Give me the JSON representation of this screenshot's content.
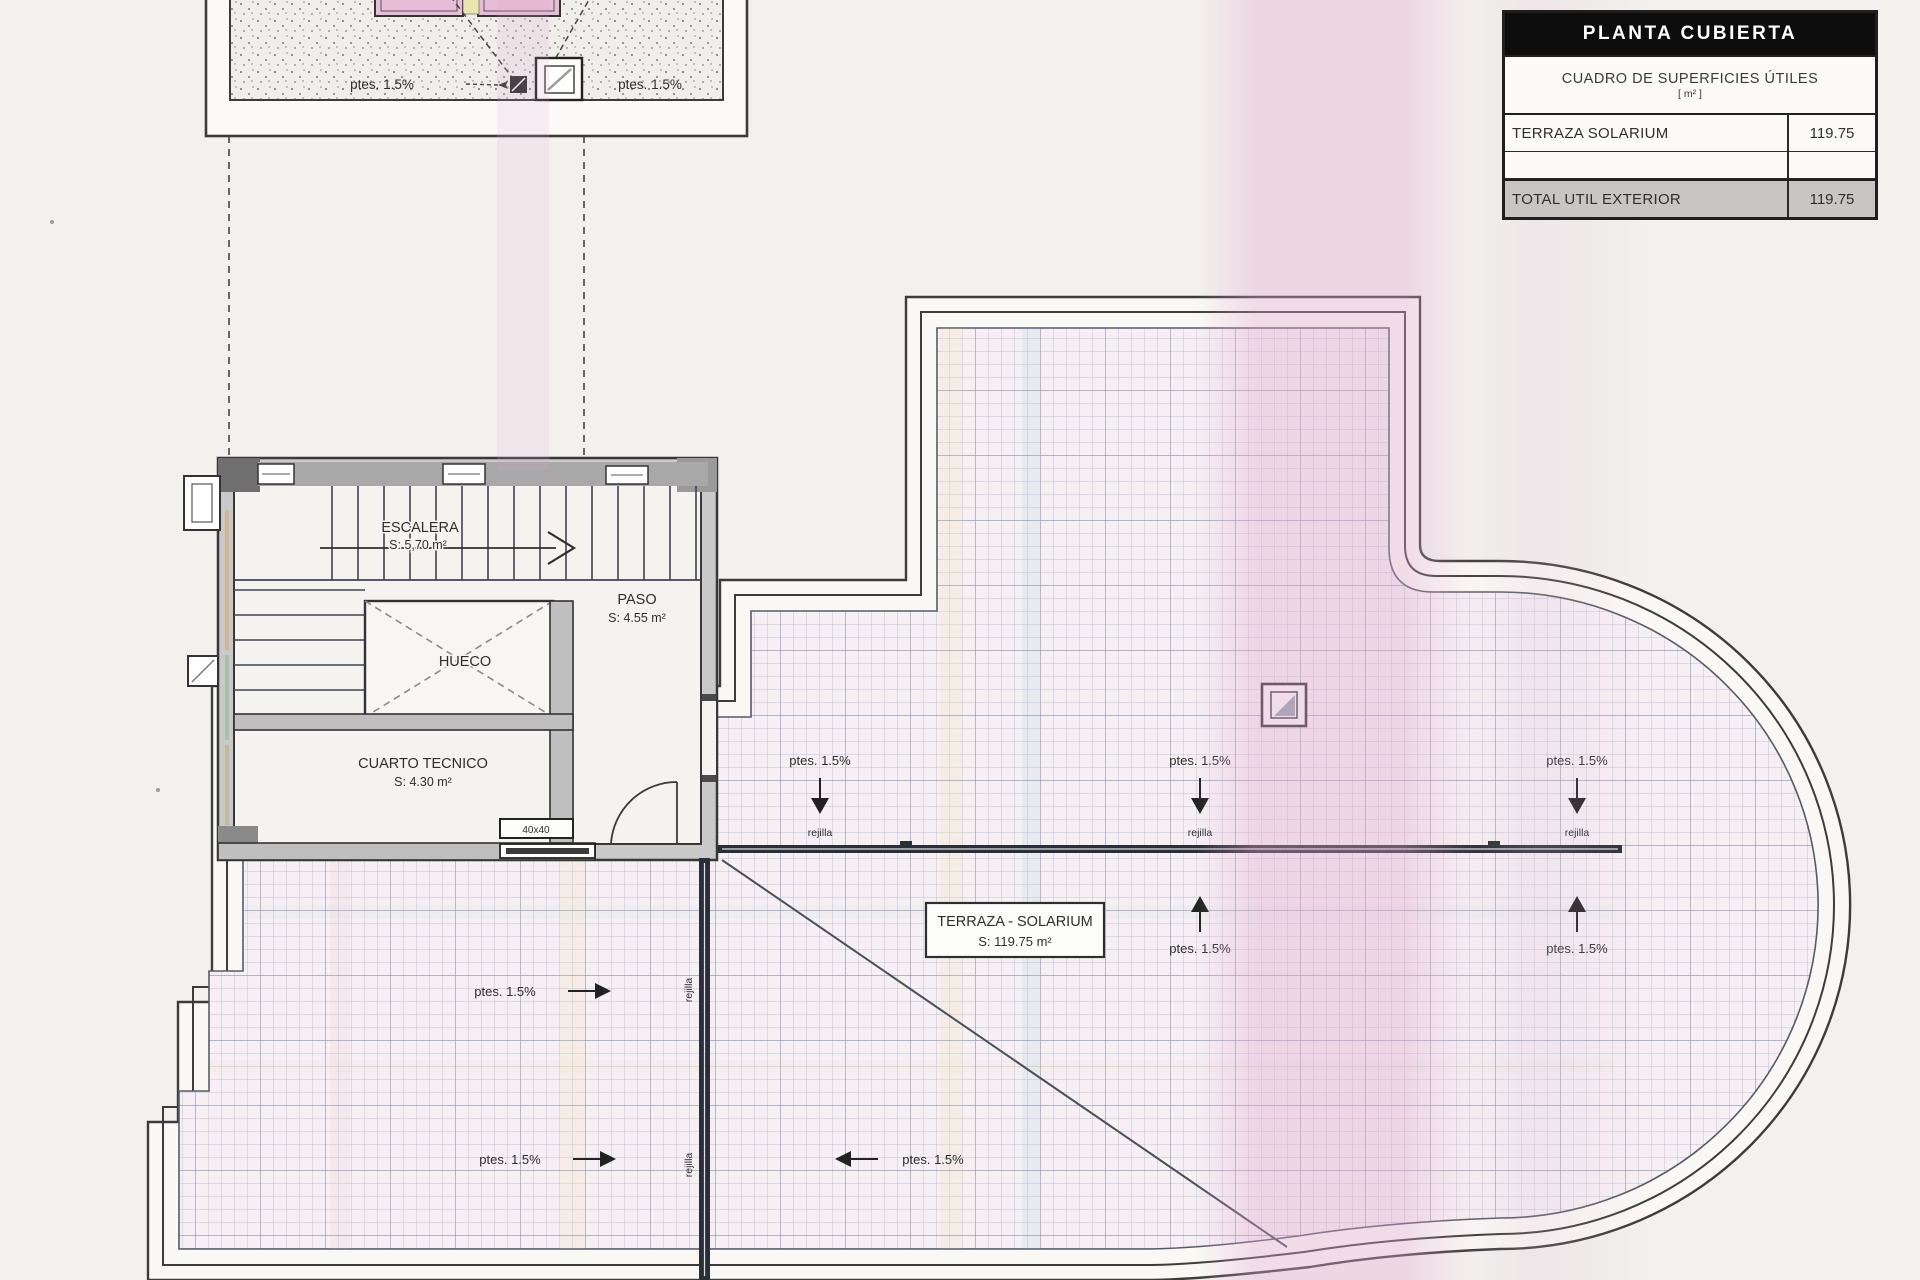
{
  "table": {
    "title": "PLANTA CUBIERTA",
    "subtitle": "CUADRO DE SUPERFICIES ÚTILES",
    "unit": "[ m² ]",
    "rows": [
      {
        "label": "TERRAZA SOLARIUM",
        "value": "119.75"
      },
      {
        "label": "",
        "value": ""
      },
      {
        "label": "TOTAL UTIL EXTERIOR",
        "value": "119.75"
      }
    ]
  },
  "rooms": {
    "escalera": {
      "name": "ESCALERA",
      "area": "S: 5,70 m²"
    },
    "paso": {
      "name": "PASO",
      "area": "S: 4.55 m²"
    },
    "hueco": {
      "name": "HUECO"
    },
    "cuarto": {
      "name": "CUARTO TECNICO",
      "area": "S: 4.30 m²"
    },
    "terraza": {
      "name": "TERRAZA - SOLARIUM",
      "area": "S: 119.75 m²"
    }
  },
  "labels": {
    "slope": "ptes. 1.5%",
    "rejilla": "rejilla",
    "vent": "40x40"
  },
  "colors": {
    "ink": "#3c3c3c",
    "grid": "#8d98b5",
    "wall_fill": "#c9c9c9",
    "scan_pink": "#dfa8cf",
    "skylight_pink": "#e6bcd6"
  }
}
